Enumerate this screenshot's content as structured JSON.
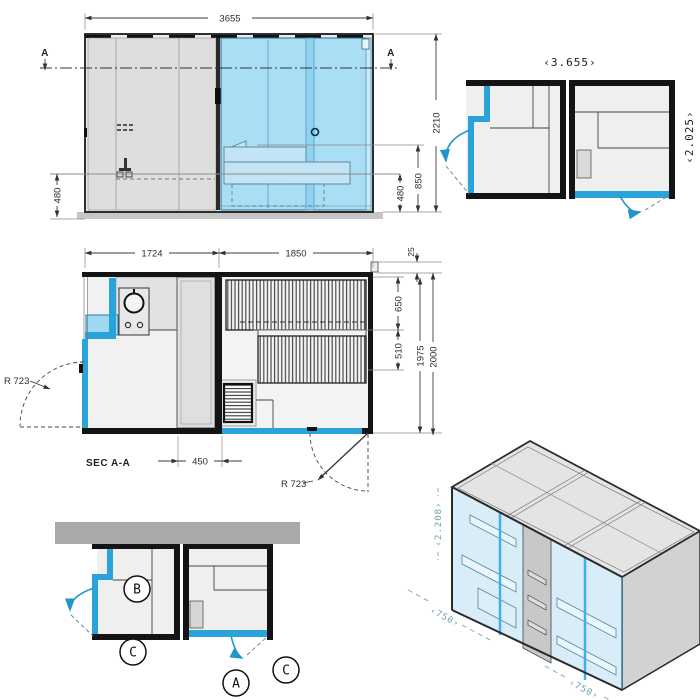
{
  "front_elevation": {
    "dim_width": "3655",
    "dim_height": "2210",
    "dim_bench_height": "850",
    "dim_480_left": "480",
    "dim_480_right": "480",
    "section_marker_left": "A",
    "section_marker_right": "A"
  },
  "top_plan": {
    "dim_length": "‹3.655›",
    "dim_depth": "‹2.025›"
  },
  "floor_plan": {
    "label": "SEC A-A",
    "dim_room_left": "1724",
    "dim_room_right": "1850",
    "dim_offset": "25",
    "dim_bench_upper": "650",
    "dim_bench_lower": "510",
    "dim_inner_depth": "1975",
    "dim_outer_depth": "2000",
    "dim_column": "450",
    "radius_left": "R 723",
    "radius_right": "R 723"
  },
  "detail_plan": {
    "marker_b": "B",
    "marker_c_left": "C",
    "marker_a": "A",
    "marker_c_right": "C"
  },
  "isometric": {
    "dim_height": "‹2.208›",
    "dim_door_left": "‹750›",
    "dim_door_right": "‹750›"
  },
  "colors": {
    "glass_blue": "#a9ddf2",
    "accent_blue": "#2aa3da",
    "wall_black": "#141414",
    "panel_gray": "#dcdcdc",
    "iso_dim_teal": "#6fa0aa"
  }
}
